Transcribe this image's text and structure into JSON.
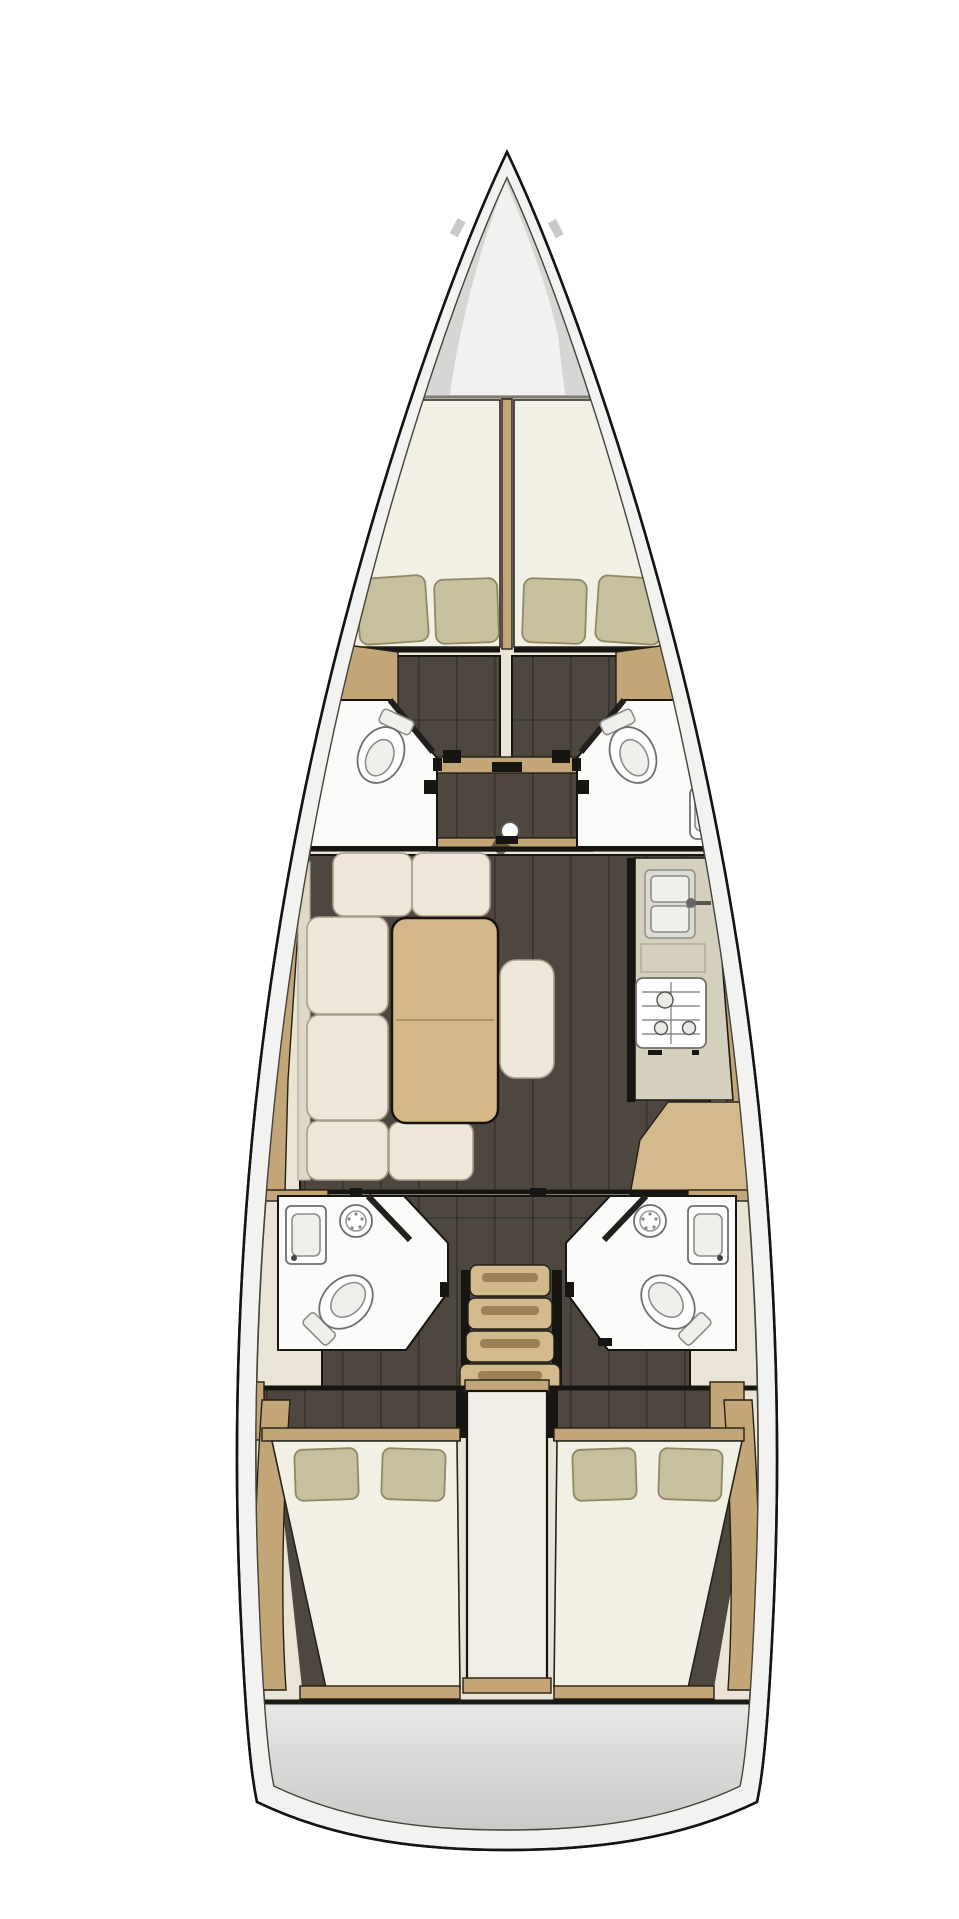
{
  "document": {
    "title": "Sailing yacht interior layout plan — top-down view",
    "view": "overhead floor plan illustration",
    "visible_text": []
  },
  "palette": {
    "hull_outline": "#181818",
    "hull_band": "#f2f2f0",
    "interior_deck": "#e9e4d5",
    "floor": "#4d4740",
    "wood": "#c2a678",
    "wood_dark": "#9b8158",
    "wood_light": "#d3ba8c",
    "table_wood": "#d3b787",
    "counter": "#d5cfbe",
    "mattress": "#f2efe5",
    "cushion": "#ece7d8",
    "cushion_edge": "#a69f8c",
    "pillow": "#c7c09e",
    "pillow_edge": "#8f8862",
    "bath_white": "#fbfbf9",
    "fixture_fill": "#efefec",
    "fixture_line": "#8c8c8a",
    "steel": "#dcdbd4",
    "black": "#161511",
    "locker": "#d6d6d4",
    "locker_light": "#f1f1ef",
    "engine_strip": "#efede6",
    "transom_top": "#e7e7e5",
    "transom_bottom": "#c6c6c4"
  },
  "areas": [
    {
      "id": "anchor-locker",
      "label": "anchor locker (bow)"
    },
    {
      "id": "forward-cabins",
      "label": "twin forward V-berth cabins",
      "pillows": 4
    },
    {
      "id": "port-forward-head",
      "label": "port forward head (toilet + sink)"
    },
    {
      "id": "starboard-forward-head",
      "label": "starboard forward head (toilet + sink)"
    },
    {
      "id": "salon",
      "label": "salon with U-shaped sofa, table and ottoman"
    },
    {
      "id": "galley",
      "label": "starboard galley (sink, 3-burner stove, counter)"
    },
    {
      "id": "companionway",
      "label": "companionway stairs (4 steps)"
    },
    {
      "id": "port-aft-head",
      "label": "port aft head (shower, sink, toilet)"
    },
    {
      "id": "starboard-aft-head",
      "label": "starboard aft head (shower, sink, toilet)"
    },
    {
      "id": "port-aft-cabin",
      "label": "port aft double cabin",
      "pillows": 2
    },
    {
      "id": "starboard-aft-cabin",
      "label": "starboard aft double cabin",
      "pillows": 2
    },
    {
      "id": "engine-box",
      "label": "engine / companionway box between aft cabins"
    },
    {
      "id": "transom",
      "label": "stern transom"
    }
  ],
  "fixtures": {
    "toilets": 4,
    "sinks": 4,
    "stove_burners": 3,
    "mast_step": 1,
    "stairs_steps": 4
  }
}
